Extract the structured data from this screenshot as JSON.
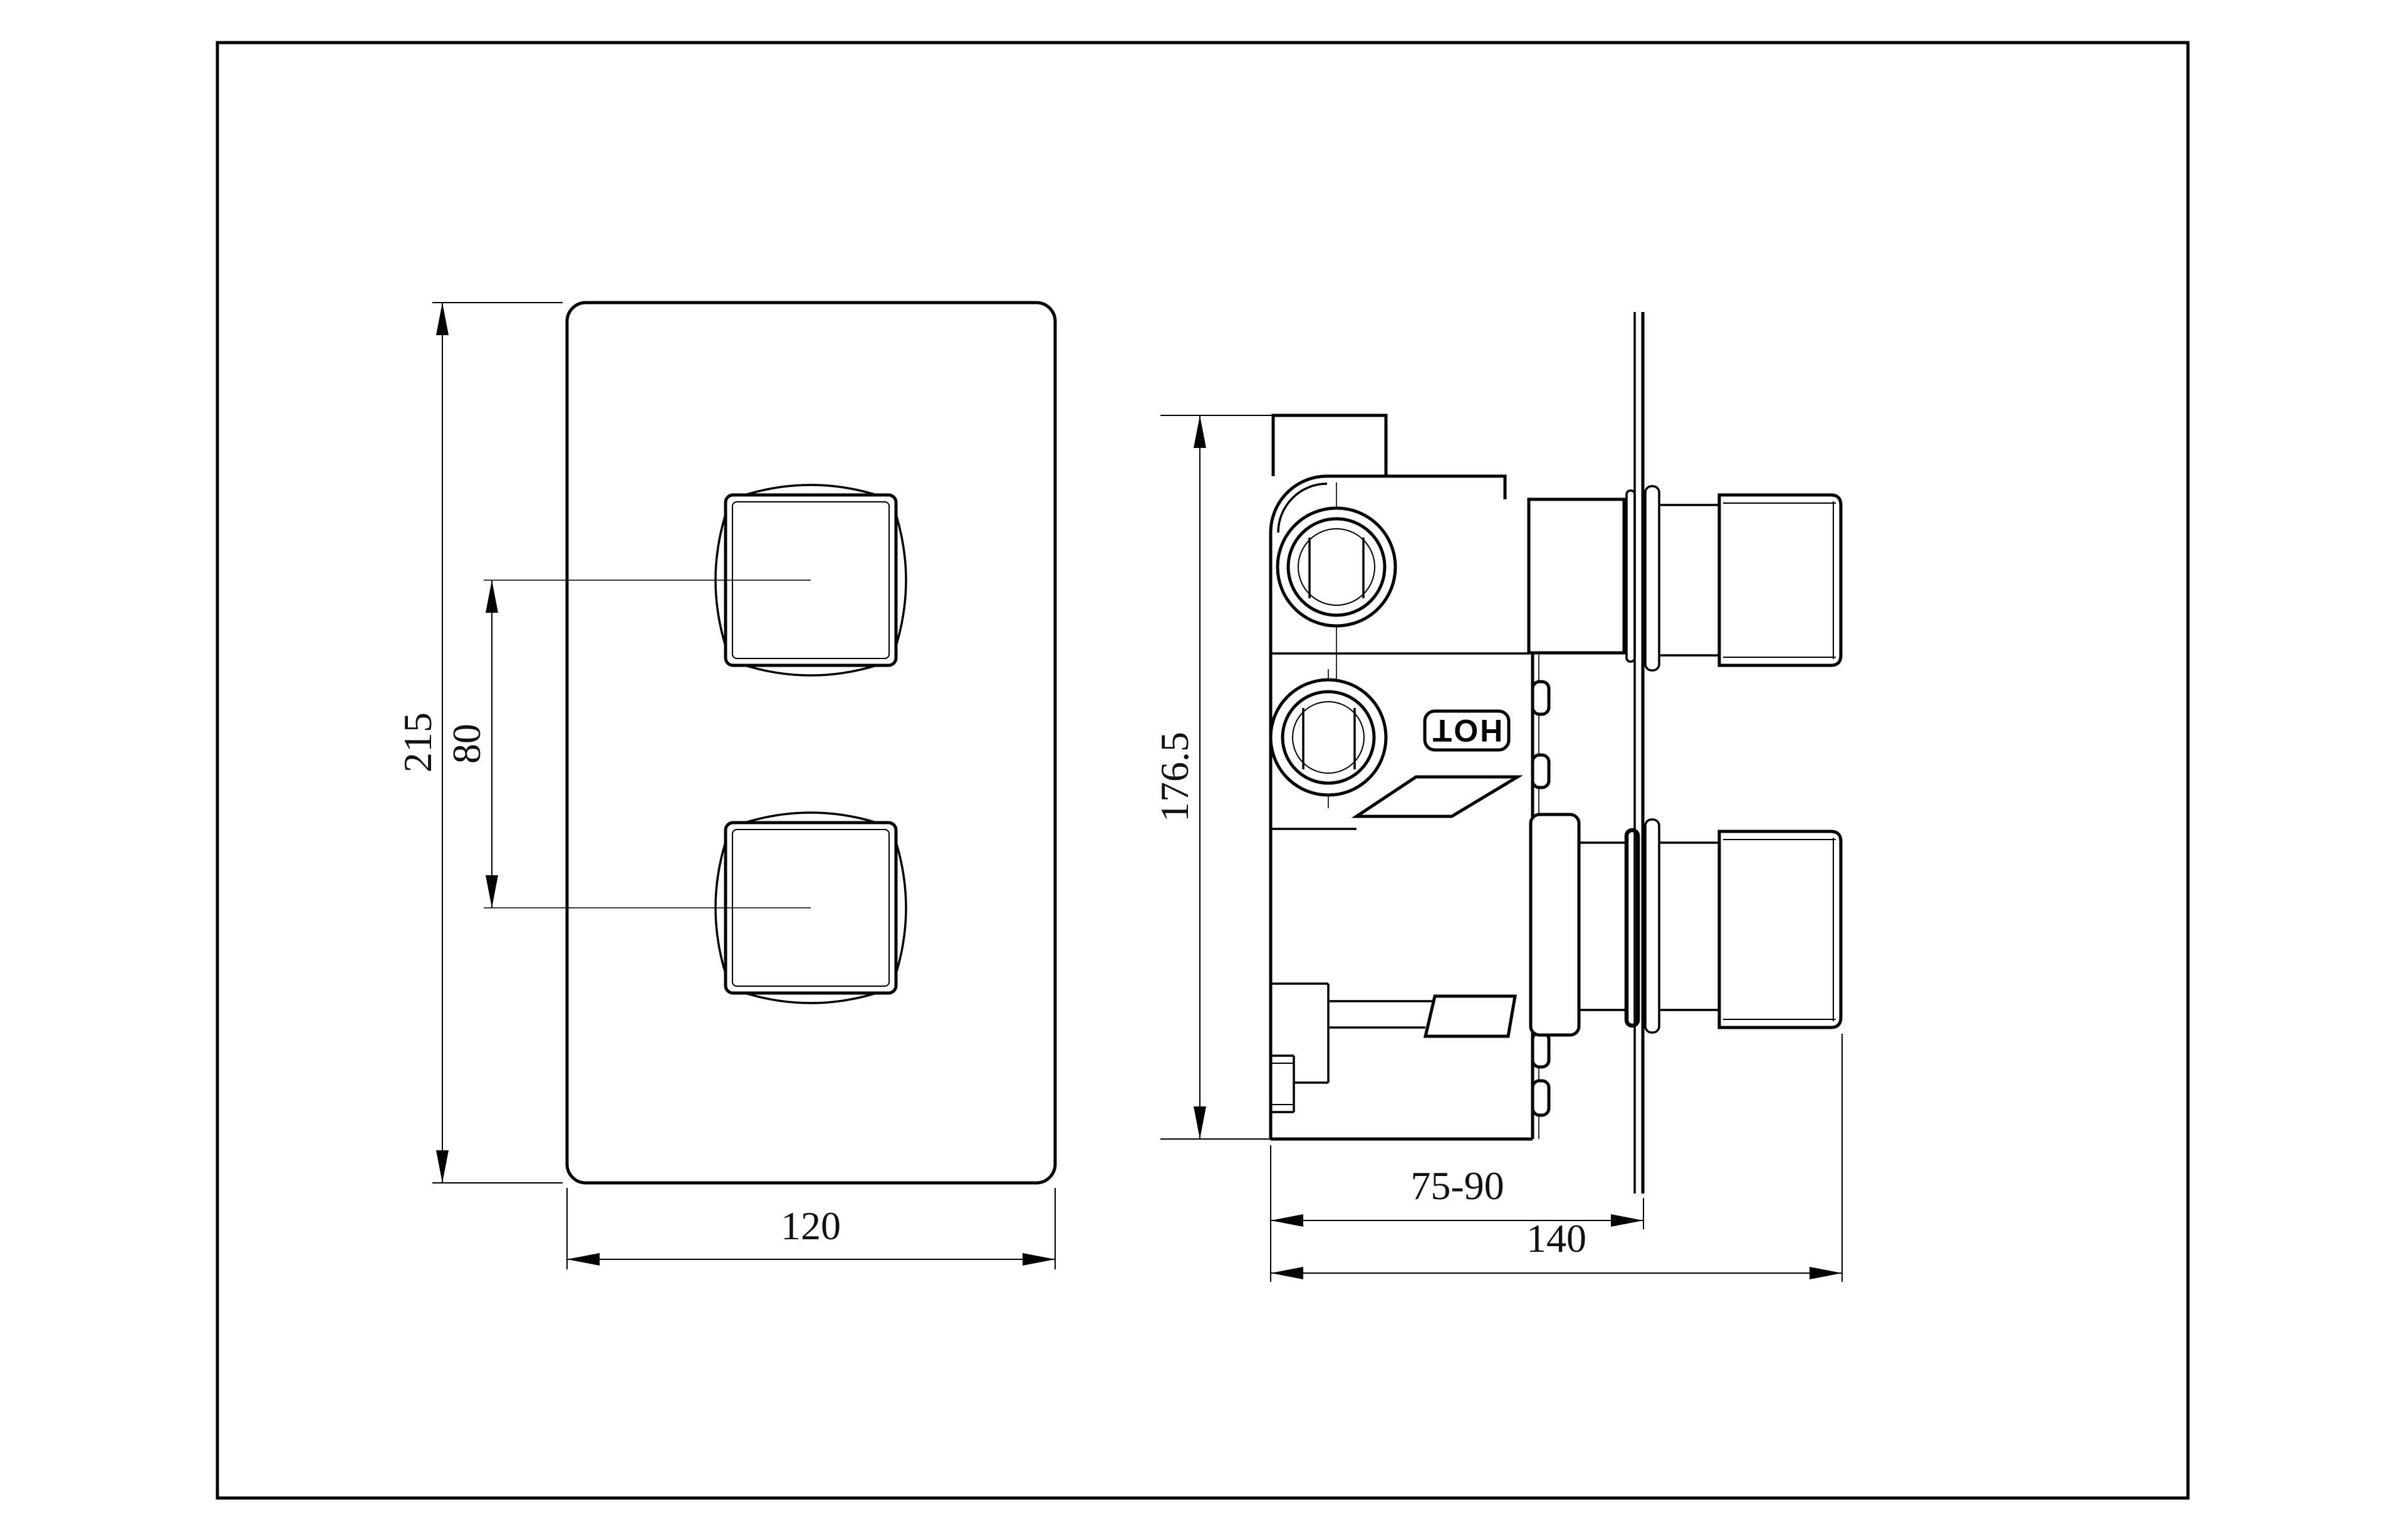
{
  "drawing": {
    "type": "technical-orthographic-drawing",
    "subject": "concealed dual-control thermostatic shower valve",
    "colors": {
      "line": "#000000",
      "background": "#ffffff",
      "text": "#111111"
    },
    "front_view": {
      "dimensions": {
        "plate_height": "215",
        "knob_spacing": "80",
        "plate_width": "120"
      }
    },
    "side_view": {
      "dimensions": {
        "body_height": "176.5",
        "wall_depth_range": "75-90",
        "total_depth": "140"
      },
      "labels": {
        "hot_port": "HOT"
      }
    }
  }
}
